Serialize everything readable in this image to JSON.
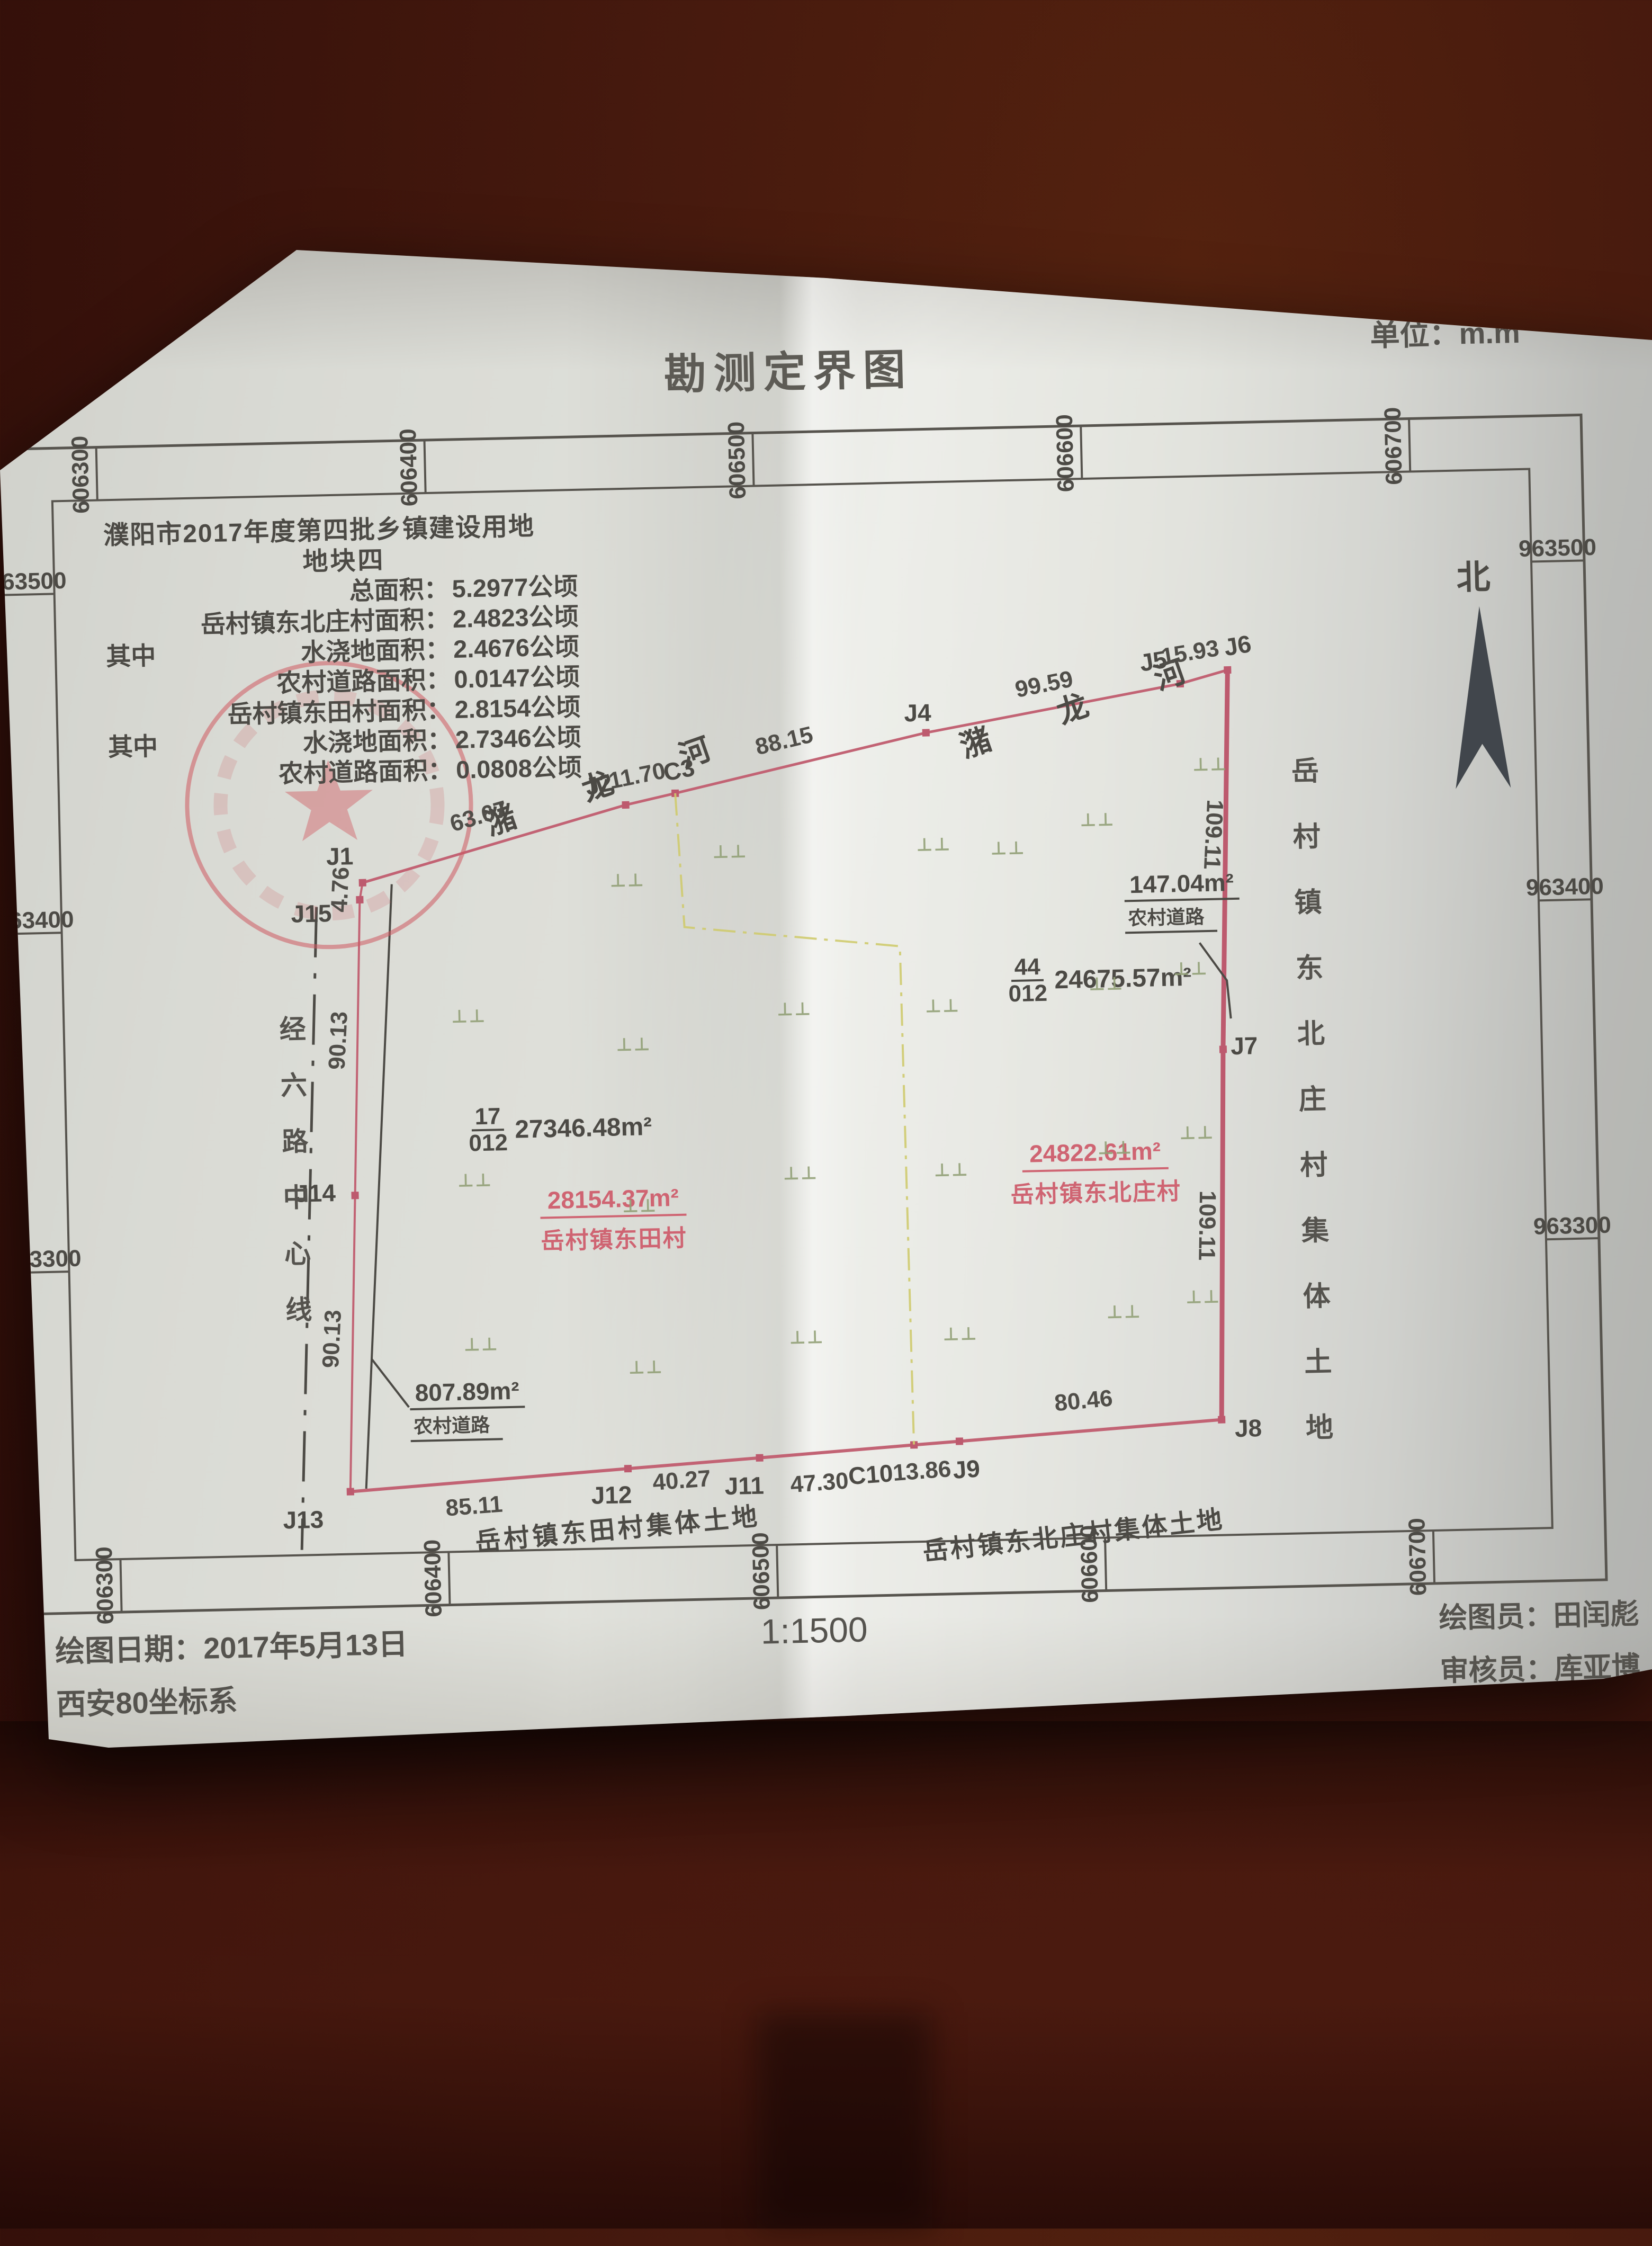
{
  "doc": {
    "title": "勘测定界图",
    "unit_label": "单位：m.m",
    "unit_sup": "2",
    "north_label": "北"
  },
  "info_block": {
    "line1": "濮阳市2017年度第四批乡镇建设用地",
    "line2": "地块四",
    "rows": [
      {
        "prefix": "",
        "label": "总面积：",
        "value": "5.2977公顷"
      },
      {
        "prefix": "",
        "label": "岳村镇东北庄村面积：",
        "value": "2.4823公顷"
      },
      {
        "prefix": "其中",
        "label": "水浇地面积：",
        "value": "2.4676公顷"
      },
      {
        "prefix": "",
        "label": "农村道路面积：",
        "value": "0.0147公顷"
      },
      {
        "prefix": "",
        "label": "岳村镇东田村面积：",
        "value": "2.8154公顷"
      },
      {
        "prefix": "其中",
        "label": "水浇地面积：",
        "value": "2.7346公顷"
      },
      {
        "prefix": "",
        "label": "农村道路面积：",
        "value": "0.0808公顷"
      }
    ]
  },
  "grid": {
    "x_labels": [
      "606300",
      "606400",
      "606500",
      "606600",
      "606700"
    ],
    "y_labels": [
      "963500",
      "963400",
      "963300"
    ]
  },
  "river": {
    "name": "潴 龙 河"
  },
  "points": [
    "J1",
    "J2",
    "C3",
    "J4",
    "J5",
    "J6",
    "J7",
    "J8",
    "J9",
    "C10",
    "J11",
    "J12",
    "J13",
    "J14",
    "J15"
  ],
  "dims": [
    "63.67",
    "11.70",
    "88.15",
    "99.59",
    "15.93",
    "109.11",
    "109.11",
    "80.46",
    "13.86",
    "47.30",
    "40.27",
    "85.11",
    "90.13",
    "90.13",
    "4.76"
  ],
  "parcels": [
    {
      "top": "17",
      "bottom": "012",
      "area": "27346.48m²"
    },
    {
      "top": "44",
      "bottom": "012",
      "area": "24675.57m²"
    }
  ],
  "red_parcels": [
    {
      "area": "28154.37m²",
      "name": "岳村镇东田村"
    },
    {
      "area": "24822.61m²",
      "name": "岳村镇东北庄村"
    }
  ],
  "road_labels": [
    {
      "area": "147.04m²",
      "name": "农村道路"
    },
    {
      "area": "807.89m²",
      "name": "农村道路"
    }
  ],
  "land_texts": {
    "dongtian_collective": "岳村镇东田村集体土地",
    "dongbeizhuang_collective": "岳村镇东北庄村集体土地",
    "road_centerline": "经六路中心线"
  },
  "symbols": {
    "irrigated_land": "⊥⊥"
  },
  "footer": {
    "date": "绘图日期：2017年5月13日",
    "coord_system": "西安80坐标系",
    "scale": "1:1500",
    "drafter": "绘图员：田闰彪",
    "reviewer": "审核员：库亚博"
  },
  "colors": {
    "boundary_red": "#c26374",
    "annotation_red": "#cf6472",
    "village_line_yellow": "#cfcb6e",
    "symbol_green": "#93a178",
    "ink": "#4c4a45"
  }
}
